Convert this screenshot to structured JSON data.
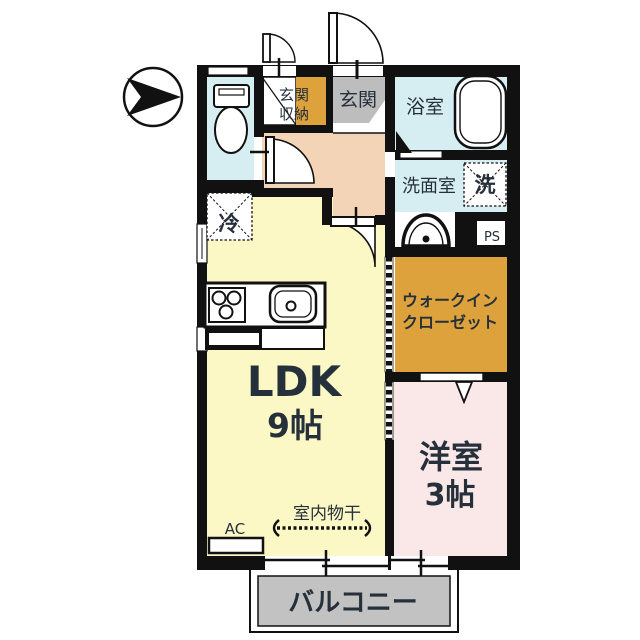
{
  "labels": {
    "genkan": "玄関",
    "genkan_storage_line1": "玄関",
    "genkan_storage_line2": "収納",
    "bath": "浴室",
    "washroom": "洗面室",
    "washer": "洗",
    "ps": "PS",
    "wic_line1": "ウォークイン",
    "wic_line2": "クローゼット",
    "ldk_name": "LDK",
    "ldk_size": "9帖",
    "western_name": "洋室",
    "western_size": "3帖",
    "balcony": "バルコニー",
    "fridge": "冷",
    "ac": "AC",
    "indoor_drying": "室内物干"
  },
  "colors": {
    "wall": "#111111",
    "water_room": "#d6eef2",
    "ldk": "#fbf8c5",
    "hall": "#f4d4b6",
    "accent_orange": "#dda23c",
    "entrance_gray": "#bdbdbd",
    "bedroom_pink": "#fae8e8",
    "balcony_gray": "#c2c2c2"
  }
}
